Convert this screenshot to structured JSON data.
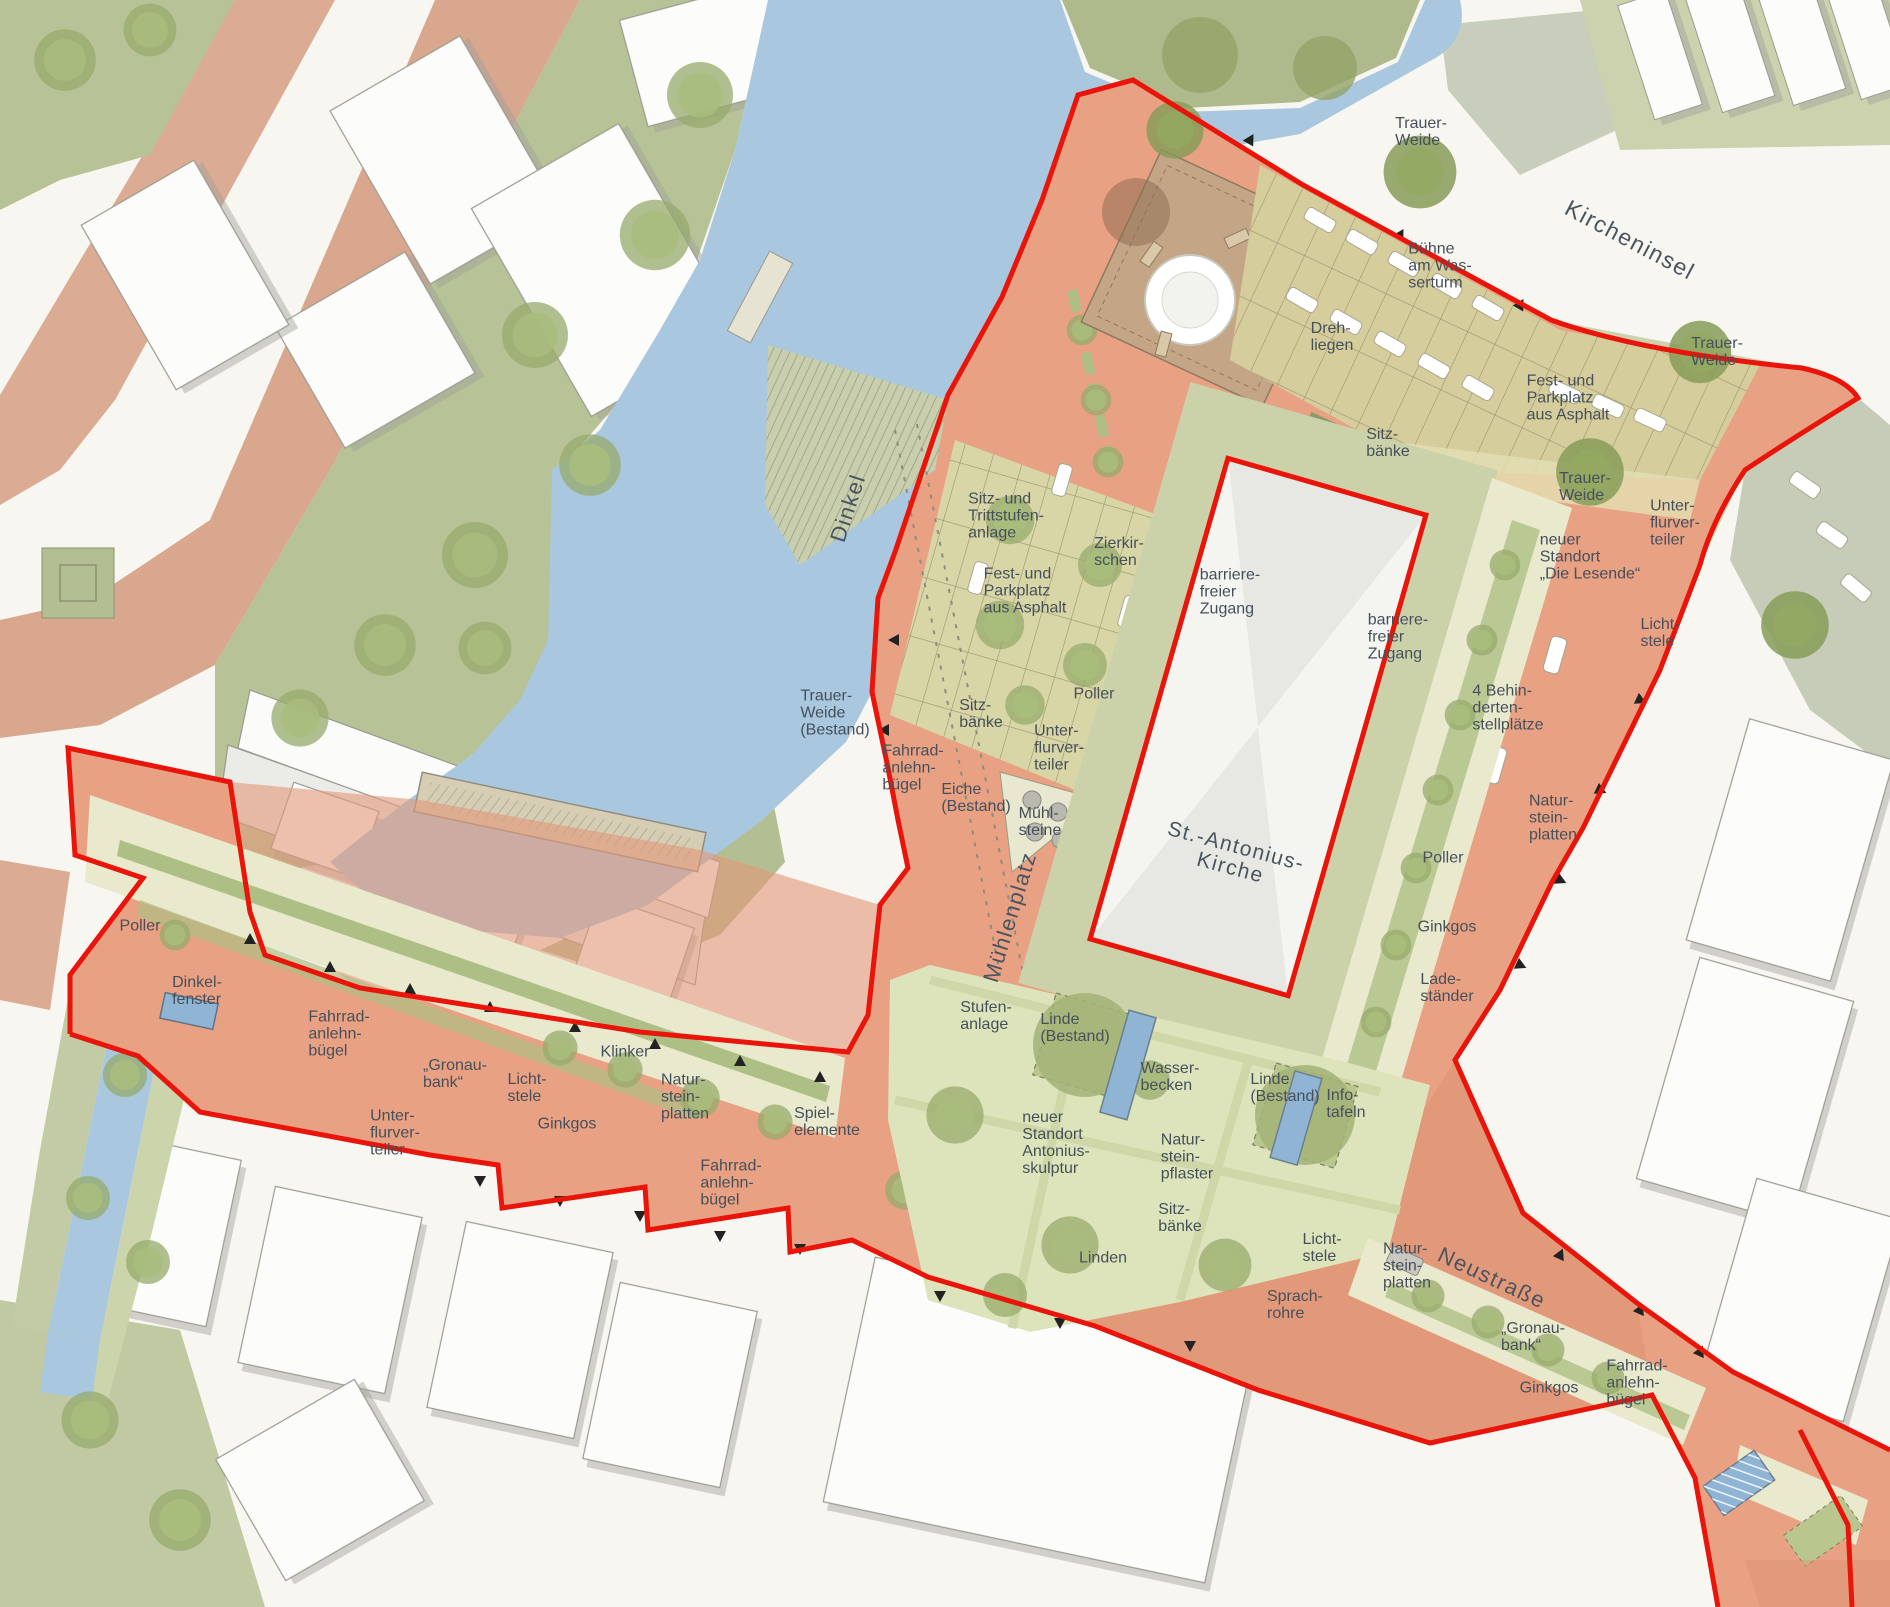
{
  "type": "landscape-site-plan",
  "colors": {
    "water": "#a9c7de",
    "park_green": "#b7c296",
    "lawn_light": "#ccd3ab",
    "plaza_green": "#dde3ba",
    "path_cream": "#e9e9cd",
    "parking_khaki": "#d5cd9c",
    "project_salmon": "#e8a183",
    "street_pink": "#dcab93",
    "stage_brown": "#c4a687",
    "building_white": "#fcfcfa",
    "building_outline": "#9b9b92",
    "boundary_red": "#e9140a",
    "label_text": "#46505b",
    "road_gray_green": "#c9cdbb"
  },
  "labels": [
    {
      "id": "trauer-weide-nw",
      "text": "Trauer-\nWeide",
      "x": 1421,
      "y": 132
    },
    {
      "id": "kircheninsel",
      "text": "Kircheninsel",
      "x": 1630,
      "y": 240,
      "rot": 28,
      "size": 23,
      "cls": "big"
    },
    {
      "id": "buehne-am-wasserturm",
      "text": "Bühne\nam Was-\nserturm",
      "x": 1440,
      "y": 266
    },
    {
      "id": "drehliegen",
      "text": "Dreh-\nliegen",
      "x": 1332,
      "y": 337
    },
    {
      "id": "fest-parkplatz-kircheninsel",
      "text": "Fest- und\nParkplatz\naus Asphalt",
      "x": 1568,
      "y": 398
    },
    {
      "id": "trauer-weide-ne",
      "text": "Trauer-\nWeide",
      "x": 1717,
      "y": 352
    },
    {
      "id": "sitzbaenke-kirche-nord",
      "text": "Sitz-\nbänke",
      "x": 1388,
      "y": 443
    },
    {
      "id": "trauer-weide-ost",
      "text": "Trauer-\nWeide",
      "x": 1585,
      "y": 487
    },
    {
      "id": "unterflurverteiler-ne",
      "text": "Unter-\nflurver-\nteiler",
      "x": 1675,
      "y": 523
    },
    {
      "id": "neuer-standort-die-lesende",
      "text": "neuer\nStandort\n„Die Lesende“",
      "x": 1590,
      "y": 557
    },
    {
      "id": "lichtstele-ne",
      "text": "Licht-\nstele",
      "x": 1660,
      "y": 633
    },
    {
      "id": "sitz-trittstufenanlage",
      "text": "Sitz- und\nTrittstufen-\nanlage",
      "x": 1006,
      "y": 516
    },
    {
      "id": "fest-parkplatz-muehlenplatz",
      "text": "Fest- und\nParkplatz\naus Asphalt",
      "x": 1025,
      "y": 591
    },
    {
      "id": "zierkirschen",
      "text": "Zierkir-\nschen",
      "x": 1119,
      "y": 552
    },
    {
      "id": "barrierefreier-zugang-west",
      "text": "barriere-\nfreier\nZugang",
      "x": 1230,
      "y": 592
    },
    {
      "id": "barrierefreier-zugang-ost",
      "text": "barriere-\nfreier\nZugang",
      "x": 1398,
      "y": 637
    },
    {
      "id": "behindertenstellplaetze",
      "text": "4 Behin-\nderten-\nstellplätze",
      "x": 1508,
      "y": 708
    },
    {
      "id": "dinkel",
      "text": "Dinkel",
      "x": 848,
      "y": 508,
      "rot": -72,
      "size": 22,
      "cls": "big"
    },
    {
      "id": "trauer-weide-bestand",
      "text": "Trauer-\nWeide\n(Bestand)",
      "x": 835,
      "y": 713
    },
    {
      "id": "fahrradanlehnbuegel-pond",
      "text": "Fahrrad-\nanlehn-\nbügel",
      "x": 913,
      "y": 768
    },
    {
      "id": "sitzbaenke-muehlenplatz",
      "text": "Sitz-\nbänke",
      "x": 981,
      "y": 714
    },
    {
      "id": "poller-muehlenplatz",
      "text": "Poller",
      "x": 1094,
      "y": 694
    },
    {
      "id": "unterflurverteiler-muehlenplatz",
      "text": "Unter-\nflurver-\nteiler",
      "x": 1059,
      "y": 748
    },
    {
      "id": "eiche-bestand",
      "text": "Eiche\n(Bestand)",
      "x": 976,
      "y": 798
    },
    {
      "id": "muehlsteine",
      "text": "Mühl-\nsteine",
      "x": 1040,
      "y": 822
    },
    {
      "id": "muehlenplatz",
      "text": "Mühlenplatz",
      "x": 1010,
      "y": 917,
      "rot": -73,
      "size": 22,
      "cls": "big"
    },
    {
      "id": "st-antonius-kirche",
      "text": "St.-Antonius-\nKirche",
      "x": 1233,
      "y": 858,
      "rot": 15,
      "size": 21,
      "cls": "big ctr"
    },
    {
      "id": "stufenanlage",
      "text": "Stufen-\nanlage",
      "x": 986,
      "y": 1016
    },
    {
      "id": "linde-bestand-1",
      "text": "Linde\n(Bestand)",
      "x": 1075,
      "y": 1028
    },
    {
      "id": "wasserbecken",
      "text": "Wasser-\nbecken",
      "x": 1170,
      "y": 1077
    },
    {
      "id": "linde-bestand-2",
      "text": "Linde\n(Bestand)",
      "x": 1285,
      "y": 1088
    },
    {
      "id": "infotafeln",
      "text": "Info-\ntafeln",
      "x": 1346,
      "y": 1104
    },
    {
      "id": "neuer-standort-antoniusskulptur",
      "text": "neuer\nStandort\nAntonius-\nskulptur",
      "x": 1056,
      "y": 1143
    },
    {
      "id": "natursteinpflaster",
      "text": "Natur-\nstein-\npflaster",
      "x": 1187,
      "y": 1157
    },
    {
      "id": "sitzbaenke-platz",
      "text": "Sitz-\nbänke",
      "x": 1180,
      "y": 1218
    },
    {
      "id": "linden",
      "text": "Linden",
      "x": 1103,
      "y": 1258
    },
    {
      "id": "lichtstele-sued",
      "text": "Licht-\nstele",
      "x": 1322,
      "y": 1248
    },
    {
      "id": "sprachrohre",
      "text": "Sprach-\nrohre",
      "x": 1295,
      "y": 1305
    },
    {
      "id": "poller-west",
      "text": "Poller",
      "x": 140,
      "y": 926
    },
    {
      "id": "dinkelfenster",
      "text": "Dinkel-\nfenster",
      "x": 197,
      "y": 991
    },
    {
      "id": "fahrradanlehnbuegel-west",
      "text": "Fahrrad-\nanlehn-\nbügel",
      "x": 339,
      "y": 1034
    },
    {
      "id": "gronaubank-west",
      "text": "„Gronau-\nbank“",
      "x": 455,
      "y": 1074
    },
    {
      "id": "lichtstele-west",
      "text": "Licht-\nstele",
      "x": 527,
      "y": 1088
    },
    {
      "id": "ginkgos-west",
      "text": "Ginkgos",
      "x": 567,
      "y": 1124
    },
    {
      "id": "klinker",
      "text": "Klinker",
      "x": 625,
      "y": 1052
    },
    {
      "id": "natursteinplatten-west",
      "text": "Natur-\nstein-\nplatten",
      "x": 685,
      "y": 1097
    },
    {
      "id": "spielelemente",
      "text": "Spiel-\nelemente",
      "x": 827,
      "y": 1122
    },
    {
      "id": "fahrradanlehnbuegel-suedwest",
      "text": "Fahrrad-\nanlehn-\nbügel",
      "x": 731,
      "y": 1183
    },
    {
      "id": "unterflurverteiler-west",
      "text": "Unter-\nflurver-\nteiler",
      "x": 395,
      "y": 1133
    },
    {
      "id": "poller-ost",
      "text": "Poller",
      "x": 1443,
      "y": 858
    },
    {
      "id": "ginkgos-ost",
      "text": "Ginkgos",
      "x": 1447,
      "y": 927
    },
    {
      "id": "ladestaender",
      "text": "Lade-\nständer",
      "x": 1447,
      "y": 988
    },
    {
      "id": "natursteinplatten-ost",
      "text": "Natur-\nstein-\nplatten",
      "x": 1553,
      "y": 818
    },
    {
      "id": "natursteinplatten-sued",
      "text": "Natur-\nstein-\nplatten",
      "x": 1407,
      "y": 1266
    },
    {
      "id": "neustrasse",
      "text": "Neustraße",
      "x": 1492,
      "y": 1278,
      "rot": 25,
      "size": 22,
      "cls": "big"
    },
    {
      "id": "gronaubank-sued",
      "text": "„Gronau-\nbank“",
      "x": 1533,
      "y": 1337
    },
    {
      "id": "ginkgos-sued",
      "text": "Ginkgos",
      "x": 1549,
      "y": 1388
    },
    {
      "id": "fahrradanlehnbuegel-suedost",
      "text": "Fahrrad-\nanlehn-\nbügel",
      "x": 1637,
      "y": 1383
    }
  ]
}
